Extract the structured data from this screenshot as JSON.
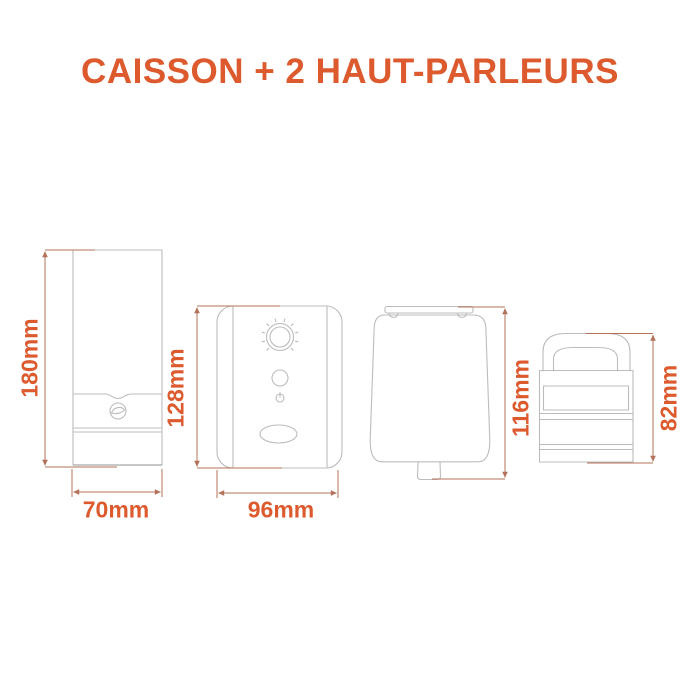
{
  "title": "CAISSON + 2 HAUT-PARLEURS",
  "colors": {
    "accent_orange": "#DC5A2E",
    "dimension_line": "#B3735A",
    "drawing_line": "#BCBCBC",
    "background": "#FFFFFF"
  },
  "products": [
    {
      "id": "subwoofer-side",
      "label_height": "180mm",
      "label_width": "70mm",
      "features": [
        "brand-logo",
        "front-panel-seams"
      ]
    },
    {
      "id": "subwoofer-back",
      "label_height": "128mm",
      "label_width": "96mm",
      "features": [
        "volume-knob",
        "round-button",
        "power-symbol",
        "bass-reflex-port"
      ]
    },
    {
      "id": "speaker-side",
      "label_height": "116mm",
      "features": [
        "top-bracket",
        "mounting-stub"
      ]
    },
    {
      "id": "speaker-with-handle",
      "label_height": "82mm",
      "features": [
        "carry-handle",
        "recessed-panel",
        "body-grooves"
      ]
    }
  ]
}
